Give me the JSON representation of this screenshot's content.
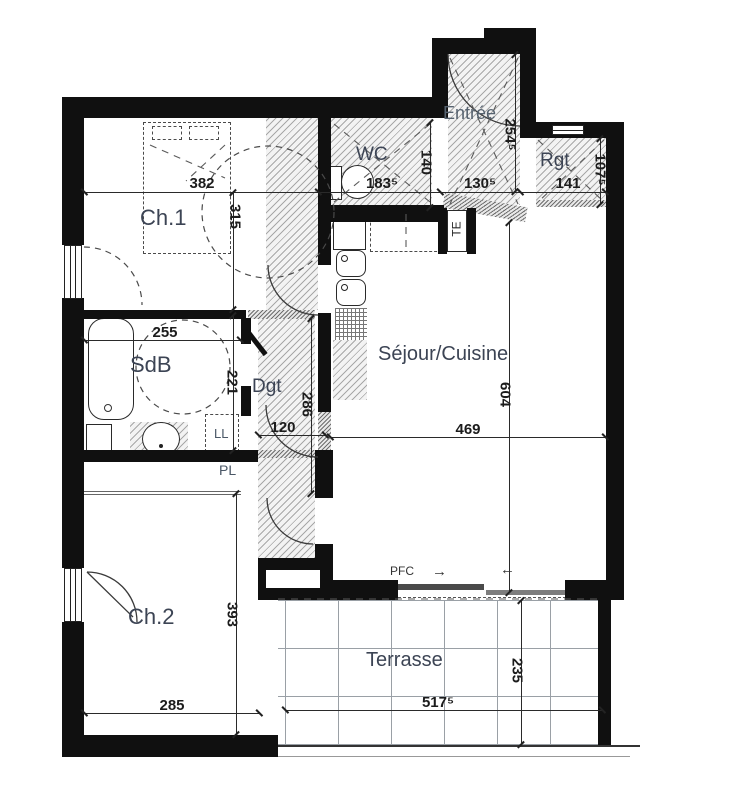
{
  "rooms": {
    "ch1": "Ch.1",
    "wc": "WC",
    "entree": "Entrée",
    "rgt": "Rgt",
    "sdb": "SdB",
    "dgt": "Dgt",
    "sejour": "Séjour/Cuisine",
    "ch2": "Ch.2",
    "terrasse": "Terrasse"
  },
  "annotations": {
    "pl": "PL",
    "ll": "LL",
    "te": "TE",
    "pfc": "PFC",
    "arrow_right": "→",
    "arrow_left": "←"
  },
  "dims": {
    "ch1_w": "382",
    "ch1_h": "315",
    "wc_w": "183⁵",
    "wc_h": "140",
    "entree_h": "254⁵",
    "entree_w": "130⁵",
    "rgt_w": "141",
    "rgt_h": "107⁵",
    "sdb_w": "255",
    "sdb_h": "221",
    "dgt_h": "286",
    "dgt_w": "120",
    "sejour_h": "604",
    "sejour_w": "469",
    "ch2_h": "393",
    "ch2_w": "285",
    "terrasse_w": "517⁵",
    "terrasse_h": "235"
  },
  "colors": {
    "wall": "#101010",
    "hatch_line": "#a8a8a8",
    "room_label": "#3c4454",
    "dim_text": "#1c1c1c",
    "terrace_grid": "#9aa0a6"
  }
}
